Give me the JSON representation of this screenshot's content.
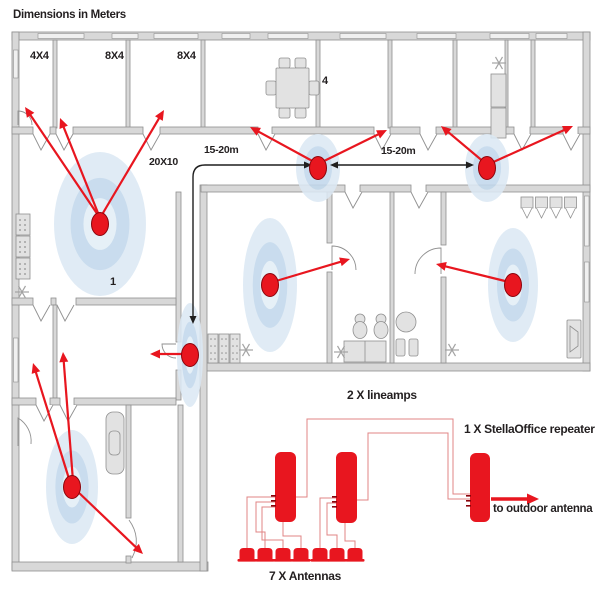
{
  "title": "Dimensions in Meters",
  "rooms": {
    "room_4x4": "4X4",
    "room_8x4_a": "8X4",
    "room_8x4_b": "8X4",
    "room_4": "4",
    "room_1": "1",
    "room_20x10": "20X10"
  },
  "measurements": {
    "span_left": "15-20m",
    "span_right": "15-20m"
  },
  "equipment": {
    "lineamps_label": "2 X lineamps",
    "repeater_label": "1 X StellaOffice repeater",
    "outdoor_label": "to outdoor antenna",
    "antennas_label": "7 X Antennas"
  },
  "colors": {
    "wall_fill": "#d8d8d8",
    "wall_stroke": "#8f8f8f",
    "window_fill": "#f0f0f0",
    "furn_fill": "#e2e2e2",
    "furn_stroke": "#909090",
    "red": "#e8161f",
    "red_dark": "#8a040c",
    "wire": "#e08484",
    "halo_outer": "#dce9f4",
    "halo_mid": "#c2d8ec",
    "halo_inner": "#e3eef7",
    "black": "#1f1f1f",
    "snow": "#a3a3a3"
  },
  "plan": {
    "walls": [
      [
        12,
        32,
        578,
        8
      ],
      [
        12,
        32,
        7,
        538
      ],
      [
        583,
        32,
        7,
        339
      ],
      [
        200,
        363,
        390,
        8
      ],
      [
        12,
        562,
        196,
        9
      ],
      [
        200,
        185,
        7,
        386
      ],
      [
        53,
        40,
        4,
        88
      ],
      [
        126,
        40,
        4,
        88
      ],
      [
        201,
        40,
        4,
        88
      ],
      [
        316,
        40,
        4,
        88
      ],
      [
        388,
        40,
        4,
        88
      ],
      [
        453,
        40,
        4,
        88
      ],
      [
        531,
        40,
        4,
        88
      ],
      [
        505,
        40,
        3,
        94
      ],
      [
        12,
        127,
        21,
        7
      ],
      [
        50,
        127,
        6,
        7
      ],
      [
        73,
        127,
        70,
        7
      ],
      [
        160,
        127,
        98,
        7
      ],
      [
        272,
        127,
        102,
        7
      ],
      [
        390,
        127,
        30,
        7
      ],
      [
        436,
        127,
        78,
        7
      ],
      [
        530,
        127,
        33,
        7
      ],
      [
        578,
        127,
        12,
        7
      ],
      [
        201,
        185,
        144,
        7
      ],
      [
        360,
        185,
        51,
        7
      ],
      [
        426,
        185,
        164,
        7
      ],
      [
        176,
        192,
        5,
        150
      ],
      [
        176,
        370,
        5,
        30
      ],
      [
        12,
        298,
        21,
        7
      ],
      [
        51,
        298,
        5,
        7
      ],
      [
        76,
        298,
        100,
        7
      ],
      [
        53,
        305,
        4,
        93
      ],
      [
        12,
        398,
        24,
        7
      ],
      [
        50,
        398,
        10,
        7
      ],
      [
        74,
        398,
        102,
        7
      ],
      [
        126,
        405,
        5,
        113
      ],
      [
        126,
        556,
        5,
        7
      ],
      [
        178,
        405,
        5,
        157
      ],
      [
        327,
        192,
        5,
        51
      ],
      [
        327,
        272,
        5,
        91
      ],
      [
        390,
        192,
        4,
        171
      ],
      [
        441,
        192,
        5,
        53
      ],
      [
        441,
        277,
        5,
        86
      ]
    ],
    "windows": [
      [
        38,
        33.5,
        46,
        5
      ],
      [
        112,
        33.5,
        26,
        5
      ],
      [
        154,
        33.5,
        44,
        5
      ],
      [
        222,
        33.5,
        28,
        5
      ],
      [
        268,
        33.5,
        40,
        5
      ],
      [
        340,
        33.5,
        46,
        5
      ],
      [
        417,
        33.5,
        39,
        5
      ],
      [
        490,
        33.5,
        39,
        5
      ],
      [
        536,
        33.5,
        31,
        5
      ],
      [
        13.5,
        50,
        4.5,
        28
      ],
      [
        13.5,
        338,
        4.5,
        44
      ],
      [
        584.5,
        196,
        4.5,
        50
      ],
      [
        584.5,
        262,
        4.5,
        40
      ]
    ],
    "vdoors": [
      [
        33,
        134
      ],
      [
        56,
        134
      ],
      [
        143,
        134
      ],
      [
        258,
        134
      ],
      [
        374,
        134
      ],
      [
        420,
        134
      ],
      [
        514,
        134
      ],
      [
        563,
        134
      ],
      [
        345,
        192
      ],
      [
        411,
        192
      ],
      [
        33,
        305
      ],
      [
        57,
        305
      ],
      [
        36,
        405
      ],
      [
        60,
        405
      ]
    ],
    "arcdoors": [
      "M18 125 L18 111 A14 14 0 0 1 32 125",
      "M18 446 L18 418 A27 27 0 0 1 31 444",
      "M176 344 L162 344 A14 14 0 0 0 176 358",
      "M332 270 L332 246 A24 24 0 0 1 356 270",
      "M441 274 L441 248 A26 26 0 0 0 415 274",
      "M129 520 Q142 538 132 558"
    ],
    "furniture": [
      [
        "table_set",
        276,
        58
      ],
      [
        "cabinet",
        491,
        74
      ],
      [
        "shelf_v",
        16,
        214
      ],
      [
        "shelf_row",
        208,
        334
      ],
      [
        "toilet",
        360,
        330
      ],
      [
        "toilet",
        381,
        330
      ],
      [
        "counter",
        344,
        341
      ],
      [
        "round_table",
        406,
        322
      ],
      [
        "chair",
        396,
        339
      ],
      [
        "chair",
        409,
        339
      ],
      [
        "hooks",
        521,
        197
      ],
      [
        "speaker",
        567,
        320
      ],
      [
        "bathtub",
        106,
        412
      ]
    ],
    "snowflakes": [
      [
        499,
        63
      ],
      [
        22,
        292
      ],
      [
        246,
        350
      ],
      [
        341,
        352
      ],
      [
        452,
        350
      ]
    ],
    "antennas": [
      [
        100,
        224,
        46,
        72
      ],
      [
        318,
        168,
        22,
        34
      ],
      [
        487,
        168,
        22,
        34
      ],
      [
        270,
        285,
        27,
        67
      ],
      [
        513,
        285,
        25,
        57
      ],
      [
        190,
        355,
        13,
        52
      ],
      [
        72,
        487,
        26,
        57
      ]
    ],
    "red_arrows": [
      [
        100,
        218,
        25,
        107
      ],
      [
        100,
        218,
        60,
        118
      ],
      [
        100,
        218,
        164,
        110
      ],
      [
        316,
        163,
        250,
        127
      ],
      [
        320,
        163,
        387,
        130
      ],
      [
        485,
        163,
        441,
        126
      ],
      [
        489,
        164,
        573,
        126
      ],
      [
        276,
        281,
        350,
        259
      ],
      [
        505,
        281,
        436,
        264
      ],
      [
        184,
        354,
        150,
        354
      ],
      [
        70,
        482,
        33,
        363
      ],
      [
        73,
        481,
        63,
        352
      ],
      [
        76,
        490,
        143,
        554
      ]
    ],
    "measure_right": {
      "x1": 336,
      "y1": 165,
      "x2": 468,
      "y2": 165,
      "tip1": [
        330,
        165
      ],
      "tip2": [
        474,
        165
      ]
    },
    "measure_left": {
      "path": "M306 165 L205 165 Q193 165 193 177 L193 318",
      "tip_right": [
        312,
        165
      ],
      "tip_down": [
        193,
        324
      ]
    }
  },
  "diagram": {
    "devices": [
      {
        "name": "lineamp-1",
        "x": 275,
        "y": 452,
        "w": 21,
        "h": 70
      },
      {
        "name": "lineamp-2",
        "x": 336,
        "y": 452,
        "w": 21,
        "h": 71
      },
      {
        "name": "stellaoffice-repeater",
        "x": 470,
        "y": 453,
        "w": 20,
        "h": 69
      }
    ],
    "ports": [
      [
        271,
        495
      ],
      [
        271,
        500
      ],
      [
        271,
        505
      ],
      [
        332,
        496
      ],
      [
        332,
        501
      ],
      [
        332,
        506
      ],
      [
        466,
        495
      ],
      [
        466,
        500
      ],
      [
        466,
        505
      ]
    ],
    "wires": [
      [
        [
          296,
          497
        ],
        [
          307,
          497
        ],
        [
          307,
          419
        ],
        [
          453,
          419
        ],
        [
          453,
          494
        ],
        [
          470,
          494
        ]
      ],
      [
        [
          357,
          500
        ],
        [
          368,
          500
        ],
        [
          368,
          433
        ],
        [
          448,
          433
        ],
        [
          448,
          499
        ],
        [
          470,
          499
        ]
      ],
      [
        [
          275,
          497
        ],
        [
          247,
          497
        ],
        [
          247,
          549
        ]
      ],
      [
        [
          275,
          502
        ],
        [
          256,
          502
        ],
        [
          256,
          532
        ],
        [
          265,
          532
        ],
        [
          265,
          549
        ]
      ],
      [
        [
          275,
          507
        ],
        [
          262,
          507
        ],
        [
          262,
          540
        ],
        [
          283,
          540
        ],
        [
          283,
          549
        ]
      ],
      [
        [
          283,
          522
        ],
        [
          283,
          536
        ],
        [
          301,
          536
        ],
        [
          301,
          549
        ]
      ],
      [
        [
          336,
          498
        ],
        [
          320,
          498
        ],
        [
          320,
          549
        ]
      ],
      [
        [
          336,
          503
        ],
        [
          327,
          503
        ],
        [
          327,
          535
        ],
        [
          337,
          535
        ],
        [
          337,
          549
        ]
      ],
      [
        [
          345,
          523
        ],
        [
          345,
          541
        ],
        [
          355,
          541
        ],
        [
          355,
          549
        ]
      ]
    ],
    "outdoor_arrow": {
      "x1": 491,
      "y1": 499,
      "x2": 527,
      "y2": 499,
      "tip": [
        539,
        499
      ]
    },
    "small_antennas_x": [
      247,
      265,
      283,
      301,
      320,
      337,
      355
    ],
    "small_antennas_y": 548
  }
}
